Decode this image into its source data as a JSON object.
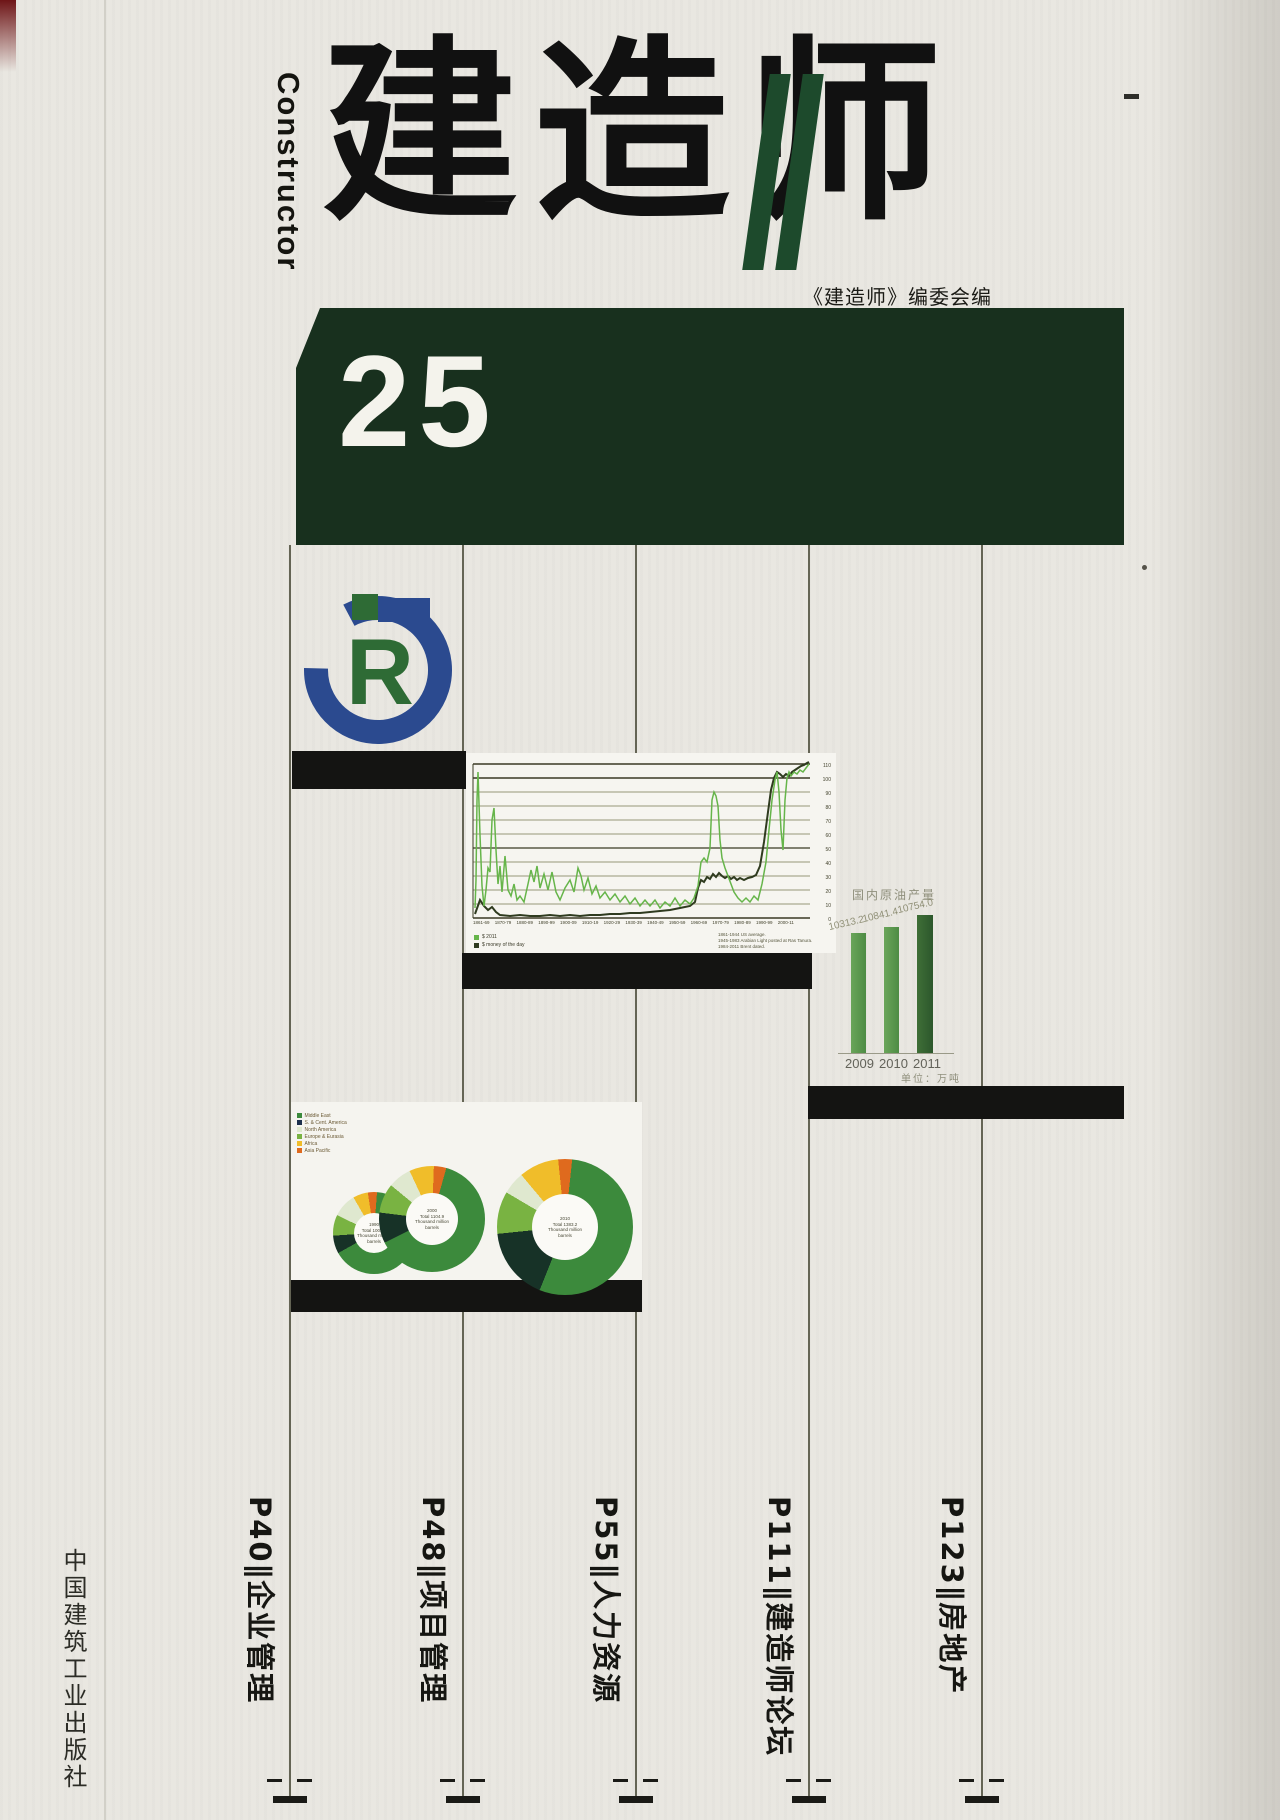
{
  "masthead": {
    "english_title": "Constructor",
    "cn_title": "建造师",
    "editor_line": "《建造师》编委会编",
    "issue_number": "25"
  },
  "logo": {
    "r_letter": "R"
  },
  "publisher": "中国建筑工业出版社",
  "toc": {
    "separator": "∥",
    "items": [
      {
        "page": "P40",
        "title": "企业管理",
        "display": "P40∥企业管理"
      },
      {
        "page": "P48",
        "title": "项目管理",
        "display": "P48∥项目管理"
      },
      {
        "page": "P55",
        "title": "人力资源",
        "display": "P55∥人力资源"
      },
      {
        "page": "P111",
        "title": "建造师论坛",
        "display": "P111∥建造师论坛"
      },
      {
        "page": "P123",
        "title": "房地产",
        "display": "P123∥房地产"
      }
    ]
  },
  "colors": {
    "banner_green": "#18301e",
    "slash_green": "#1d4a2c",
    "logo_blue": "#2b4a8f",
    "logo_green": "#2e6b35",
    "line_green": "#66b54a",
    "line_dark": "#2f3b1f"
  },
  "oil_chart": {
    "legend": [
      {
        "label": "$ 2011",
        "sq_style": "background:#66b54a"
      },
      {
        "label": "$ money of the day",
        "sq_style": "background:#2f3b1f"
      }
    ],
    "notes": "1861-1944 US average.\n1945-1983 Arabian Light posted at Ras Tanura.\n1984-2011 Brent dated.",
    "yticks_display": "110\n100\n90\n80\n70\n60\n50\n40\n30\n20\n10\n0",
    "xticks_display": "1861-69 1870-79 1880-89 1890-99 1900-09 1910-19 1920-29 1930-39 1940-49 1950-59 1960-69 1970-79 1980-89 1990-99 2000-11",
    "green_points": "9,155 10,127 11,47 12,19 14,82 16,133 18,153 20,137 22,115 24,119 26,67 28,55 30,97 32,131 34,113 36,139 39,103 42,137 45,143 48,131 51,147 54,143 58,149 62,131 65,117 68,129 71,113 74,135 78,121 82,137 86,119 90,139 94,147 99,135 104,127 108,139 112,115 115,123 118,137 122,125 126,141 130,133 134,145 139,139 144,147 149,141 154,149 159,143 164,151 169,145 174,153 179,147 184,153 189,147 194,155 199,149 204,153 209,145 214,153 219,147 224,151 228,145 232,133 235,109 238,105 241,109 244,95 246,47 248,39 250,43 252,53 254,87 256,105 259,115 262,123 265,131 268,139 272,145 276,149 280,145 284,149 288,143 292,147 296,131 300,109 303,77 306,47 309,27 311,19 313,39 315,77 317,97 319,47 321,25 323,19 325,23 328,19 331,21 334,17 337,19 340,15 343,11",
    "dark_points": "9,161 14,147 18,153 22,157 26,154 30,159 34,162 44,163 54,162 64,163 74,163 84,162 94,163 104,162 114,163 124,162 134,162 144,161 154,161 164,160 174,160 184,159 194,158 204,157 214,155 224,153 229,149 232,135 235,127 238,129 241,124 244,126 247,121 250,124 253,120 256,123 259,125 262,123 265,126 268,124 271,127 274,125 278,127 282,125 286,124 290,122 294,113 298,89 302,59 305,37 308,25 311,19 314,21 317,24 320,21 323,23 326,19 329,17 332,15 335,13 338,12 341,10 343,9"
  },
  "crude_chart": {
    "title": "国内原油产量",
    "unit": "单位：万吨",
    "bars": [
      {
        "value": "10313.2",
        "year": "2009",
        "bar_style": "left:851px;width:15px;height:120px;background:linear-gradient(90deg,#6aa55a,#4d8c44)",
        "label_pos": "left:830px;top:922px",
        "year_pos": "left:845px"
      },
      {
        "value": "10841.4",
        "year": "2010",
        "bar_style": "left:884px;width:15px;height:126px;background:linear-gradient(90deg,#6aa55a,#4d8c44)",
        "label_pos": "left:864px;top:914px",
        "year_pos": "left:879px"
      },
      {
        "value": "10754.0",
        "year": "2011",
        "bar_style": "left:917px;width:16px;height:138px;background:linear-gradient(90deg,#3f6f37,#2c572c)",
        "label_pos": "left:899px;top:905px",
        "year_pos": "left:913px"
      }
    ]
  },
  "pies": {
    "legend": [
      {
        "label": "Middle East",
        "sq_style": "background:#3c8a3c"
      },
      {
        "label": "S. & Cent. America",
        "sq_style": "background:#1c2f4d"
      },
      {
        "label": "North America",
        "sq_style": "background:#dfe8cf"
      },
      {
        "label": "Europe & Eurasia",
        "sq_style": "background:#79b342"
      },
      {
        "label": "Africa",
        "sq_style": "background:#f0bd2a"
      },
      {
        "label": "Asia Pacific",
        "sq_style": "background:#df6a1e"
      }
    ],
    "donuts": [
      {
        "center_text": "1990\nTotal 1003.2\nThousand million\nbarrels",
        "gradient_css": "background:conic-gradient(from 330deg,#f0bd2a 0% 5.9%,#df6a1e 5.9% 9.5%,#3c8a3c 9.5% 75.2%,#173227 75.2% 82.3%,#79b342 82.3% 90.5%,#dfe8cf 90.5% 100%)"
      },
      {
        "center_text": "2000\nTotal 1104.9\nThousand million\nbarrels",
        "gradient_css": "background:conic-gradient(from 335deg,#f0bd2a 0% 7.5%,#df6a1e 7.5% 11.3%,#3c8a3c 11.3% 74.6%,#173227 74.6% 83.9%,#79b342 83.9% 92.9%,#dfe8cf 92.9% 100%)"
      },
      {
        "center_text": "2010\nTotal 1383.2\nThousand million\nbarrels",
        "gradient_css": "background:conic-gradient(from 320deg,#f0bd2a 0% 9.5%,#df6a1e 9.5% 12.8%,#3c8a3c 12.8% 67.2%,#173227 67.2% 84.5%,#79b342 84.5% 94.6%,#dfe8cf 94.6% 100%)"
      }
    ]
  },
  "chart_data": [
    {
      "type": "line",
      "title": "Crude oil prices 1861-2011",
      "xlabel": "decades 1861-69 … 2000-11",
      "ylabel": "US dollars per barrel",
      "ylim": [
        0,
        120
      ],
      "legend_position": "bottom-left",
      "grid": true,
      "series": [
        {
          "name": "$ 2011",
          "x": [
            1861,
            1864,
            1870,
            1880,
            1890,
            1900,
            1910,
            1920,
            1930,
            1940,
            1950,
            1960,
            1970,
            1974,
            1980,
            1986,
            1990,
            1998,
            2000,
            2005,
            2008,
            2009,
            2011
          ],
          "values": [
            25,
            110,
            45,
            25,
            20,
            25,
            20,
            25,
            15,
            18,
            17,
            15,
            10,
            55,
            95,
            30,
            35,
            17,
            35,
            60,
            100,
            65,
            110
          ]
        },
        {
          "name": "$ money of the day",
          "x": [
            1861,
            1864,
            1870,
            1880,
            1890,
            1900,
            1910,
            1920,
            1930,
            1940,
            1950,
            1960,
            1970,
            1974,
            1980,
            1986,
            1990,
            1998,
            2000,
            2005,
            2008,
            2009,
            2011
          ],
          "values": [
            0.5,
            8,
            4,
            1,
            1,
            1,
            1,
            3,
            1,
            1,
            2,
            2,
            2,
            12,
            36,
            14,
            23,
            13,
            28,
            55,
            97,
            62,
            111
          ]
        }
      ],
      "annotations": [
        "1861-1944 US average.",
        "1945-1983 Arabian Light posted at Ras Tanura.",
        "1984-2011 Brent dated."
      ]
    },
    {
      "type": "bar",
      "title": "国内原油产量",
      "categories": [
        "2009",
        "2010",
        "2011"
      ],
      "values": [
        10313.2,
        10841.4,
        10754.0
      ],
      "xlabel": "年份",
      "ylabel": "单位：万吨",
      "grid": false
    },
    {
      "type": "pie",
      "title": "Distribution of proved oil reserves (thousand million barrels)",
      "legend_position": "top-left",
      "series": [
        {
          "name": "1990, Total 1003.2",
          "categories": [
            "Africa",
            "Asia Pacific",
            "Middle East",
            "S. & Cent. America",
            "Europe & Eurasia",
            "North America"
          ],
          "values": [
            5.9,
            3.6,
            65.7,
            7.1,
            8.2,
            9.5
          ]
        },
        {
          "name": "2000, Total 1104.9",
          "categories": [
            "Africa",
            "Asia Pacific",
            "Middle East",
            "S. & Cent. America",
            "Europe & Eurasia",
            "North America"
          ],
          "values": [
            7.5,
            3.8,
            63.3,
            9.3,
            9.0,
            7.1
          ]
        },
        {
          "name": "2010, Total 1383.2",
          "categories": [
            "Africa",
            "Asia Pacific",
            "Middle East",
            "S. & Cent. America",
            "Europe & Eurasia",
            "North America"
          ],
          "values": [
            9.5,
            3.3,
            54.4,
            17.3,
            10.1,
            5.4
          ]
        }
      ]
    }
  ]
}
